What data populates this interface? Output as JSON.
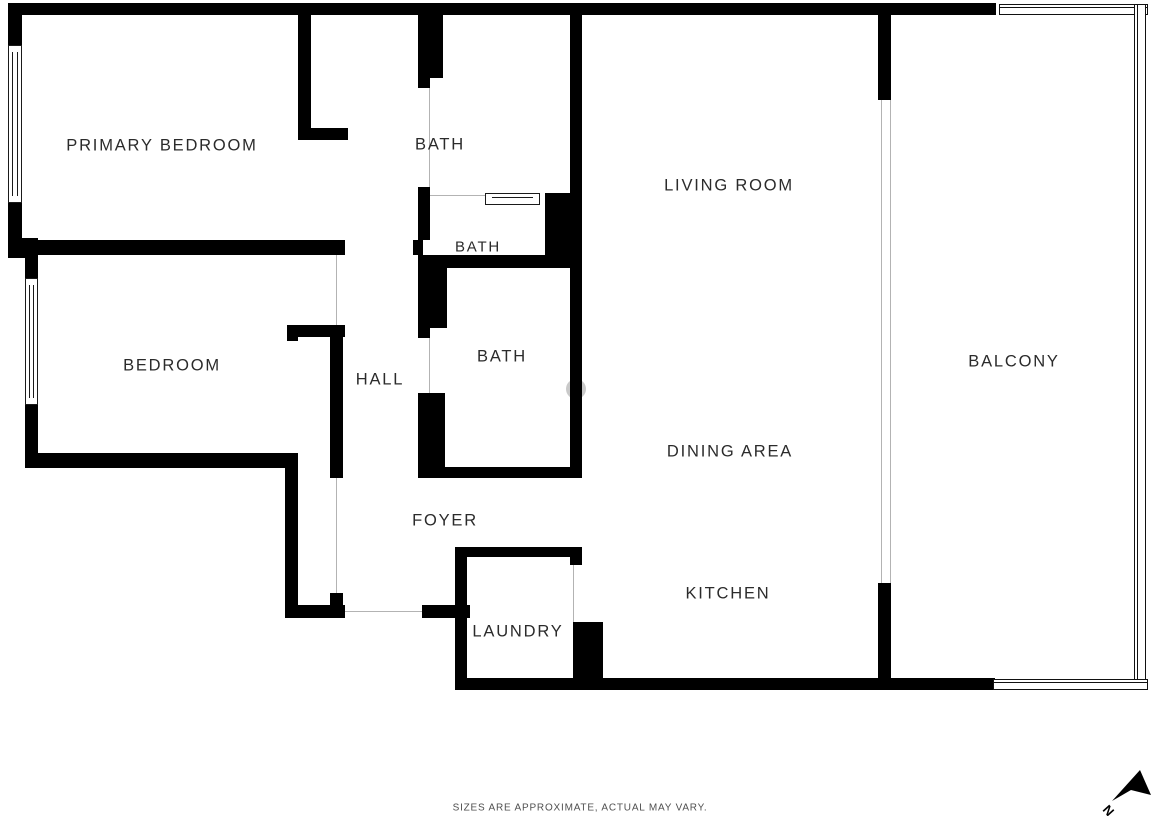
{
  "rooms": [
    {
      "id": "primary-bedroom",
      "label": "PRIMARY BEDROOM"
    },
    {
      "id": "bath-ensuite",
      "label": "BATH"
    },
    {
      "id": "living-room",
      "label": "LIVING ROOM"
    },
    {
      "id": "bath-powder",
      "label": "BATH"
    },
    {
      "id": "bedroom",
      "label": "BEDROOM"
    },
    {
      "id": "hall",
      "label": "HALL"
    },
    {
      "id": "bath-hall",
      "label": "BATH"
    },
    {
      "id": "balcony",
      "label": "BALCONY"
    },
    {
      "id": "dining-area",
      "label": "DINING AREA"
    },
    {
      "id": "foyer",
      "label": "FOYER"
    },
    {
      "id": "kitchen",
      "label": "KITCHEN"
    },
    {
      "id": "laundry",
      "label": "LAUNDRY"
    }
  ],
  "footer": {
    "disclaimer": "SIZES ARE APPROXIMATE, ACTUAL MAY VARY."
  },
  "compass": {
    "label": "N"
  },
  "colors": {
    "wall": "#000000",
    "opening_line": "#b3b3b3",
    "label_text": "#2b2b2b",
    "footer_text": "#4f4f4f",
    "watermark": "#c9c9c9",
    "background": "#ffffff"
  }
}
